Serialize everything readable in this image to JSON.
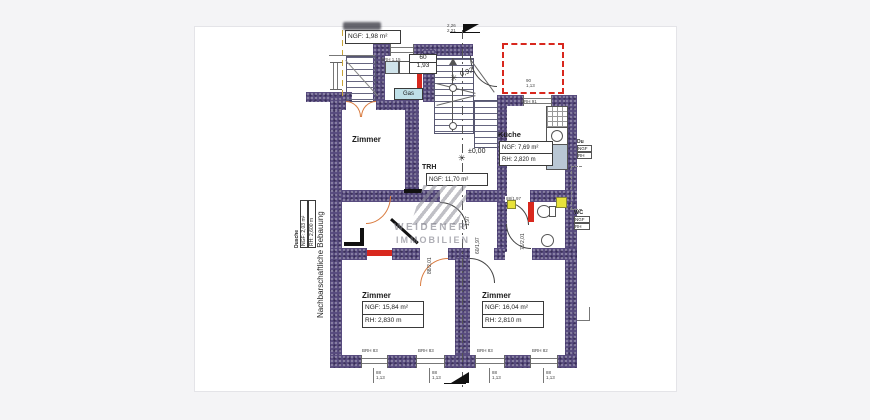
{
  "watermark": {
    "line1": "WEIDENER",
    "line2": "IMMOBILIEN"
  },
  "side_note": "Nachbarschaftliche Bebauung",
  "rooms": {
    "storage": {
      "ngf": "NGF: 1,98 m²"
    },
    "zimmer_top": {
      "name": "Zimmer"
    },
    "trh": {
      "name": "TRH",
      "ngf": "NGF: 11,70 m²"
    },
    "kueche": {
      "name": "Küche",
      "ngf": "NGF: 7,69 m²",
      "rh": "RH: 2,820 m"
    },
    "dusche": {
      "name": "Dusche",
      "ngf": "NGF: 2,03 m²",
      "rh": "RH: 2,600 m"
    },
    "wc": {
      "name": "WC",
      "ngf": "NGF",
      "rh": "RH"
    },
    "du_side": {
      "name": "Du",
      "ngf": "NGF",
      "rh": "RH"
    },
    "zimmer_bl": {
      "name": "Zimmer",
      "ngf": "NGF: 15,84 m²",
      "rh": "RH: 2,830 m"
    },
    "zimmer_br": {
      "name": "Zimmer",
      "ngf": "NGF: 16,04 m²",
      "rh": "RH: 2,810 m"
    }
  },
  "levels": {
    "entry": "±0,00",
    "step": "0,92"
  },
  "doors": {
    "top": "60",
    "top_h": "1,93",
    "flur1": "1,97",
    "flur2": "60/1,97",
    "wc_corr": "88/1,97",
    "wc": "76/2,01",
    "room_bl": "88/2,01"
  },
  "windows": {
    "brh_1": "BRH 83",
    "brh_2": "BRH 83",
    "brh_3": "BRH 83",
    "brh_4": "BRH 82",
    "dim_w": "88",
    "dim_h": "1,13",
    "kitchen_brh": "BRH 91",
    "kitchen_dim_w": "90",
    "kitchen_dim_h": "1,13",
    "porch_brh": "BRH 1,15"
  },
  "annotations": {
    "gas": "Gas",
    "flag_a": "2,26",
    "flag_b": "2,21"
  }
}
